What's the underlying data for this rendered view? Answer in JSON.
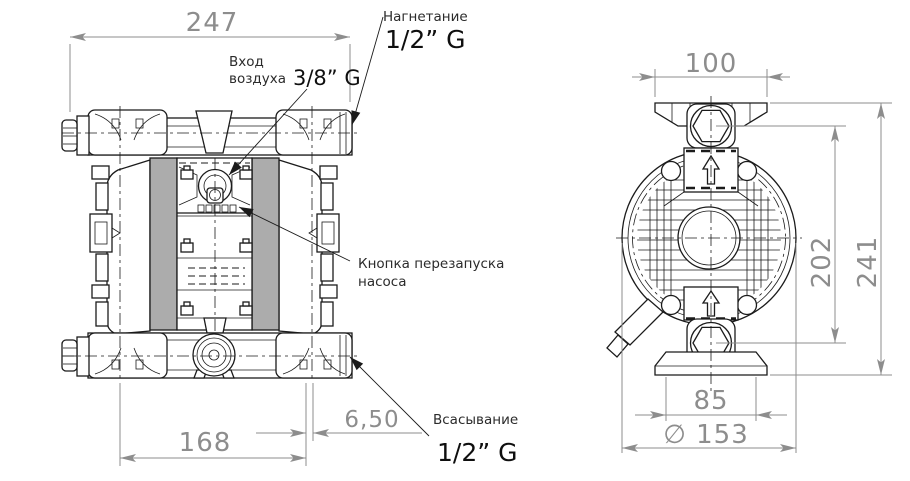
{
  "views": {
    "front": {
      "dims": {
        "overall_width": "247",
        "ports_distance": "168",
        "offset": "6,50"
      },
      "labels": {
        "discharge": "Нагнетание",
        "discharge_size": "1/2” G",
        "air_inlet_1": "Вход",
        "air_inlet_2": "воздуха",
        "air_inlet_size": "3/8” G",
        "restart_1": "Кнопка перезапуска",
        "restart_2": "насоса",
        "suction": "Всасывание",
        "suction_size": "1/2” G"
      }
    },
    "side": {
      "dims": {
        "flange_width": "100",
        "port_center_height": "202",
        "overall_height": "241",
        "foot_width": "85",
        "body_diameter": "∅ 153"
      }
    }
  },
  "colors": {
    "panel_gray": "#acacac",
    "dim_gray": "#8d8d8d",
    "line_dark": "#1b1b1b",
    "label_dark": "#2b2b2b"
  }
}
